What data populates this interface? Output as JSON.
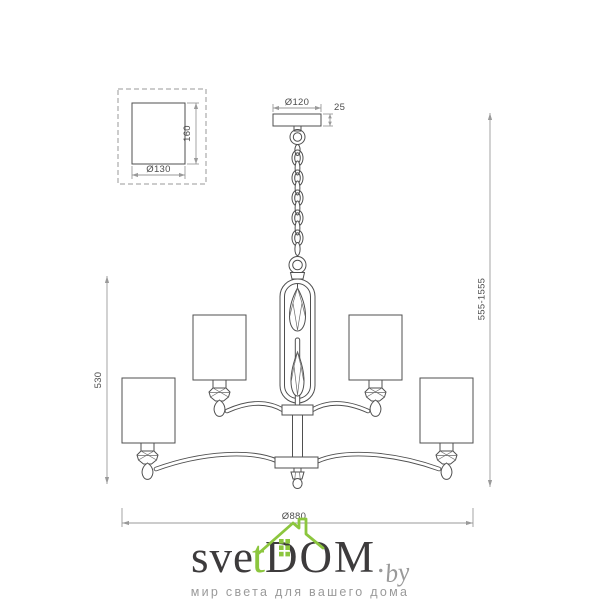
{
  "dimensions": {
    "shade_detail": {
      "diameter": "Ø130",
      "height": "160"
    },
    "canopy": {
      "diameter": "Ø120",
      "thickness": "25"
    },
    "body_height": "530",
    "overall_height": "555-1555",
    "overall_width": "Ø880"
  },
  "logo": {
    "part_sve": "sve",
    "part_t": "t",
    "part_dom": "DOM",
    "part_dot": ".",
    "part_by": "by",
    "tagline": "мир света для вашего дома"
  },
  "colors": {
    "drawing_line": "#4f4f4f",
    "dimension_line": "#9a9a9a",
    "logo_dark": "#3d3b3c",
    "logo_green": "#8cc63e",
    "logo_gray": "#9a9a9a"
  }
}
